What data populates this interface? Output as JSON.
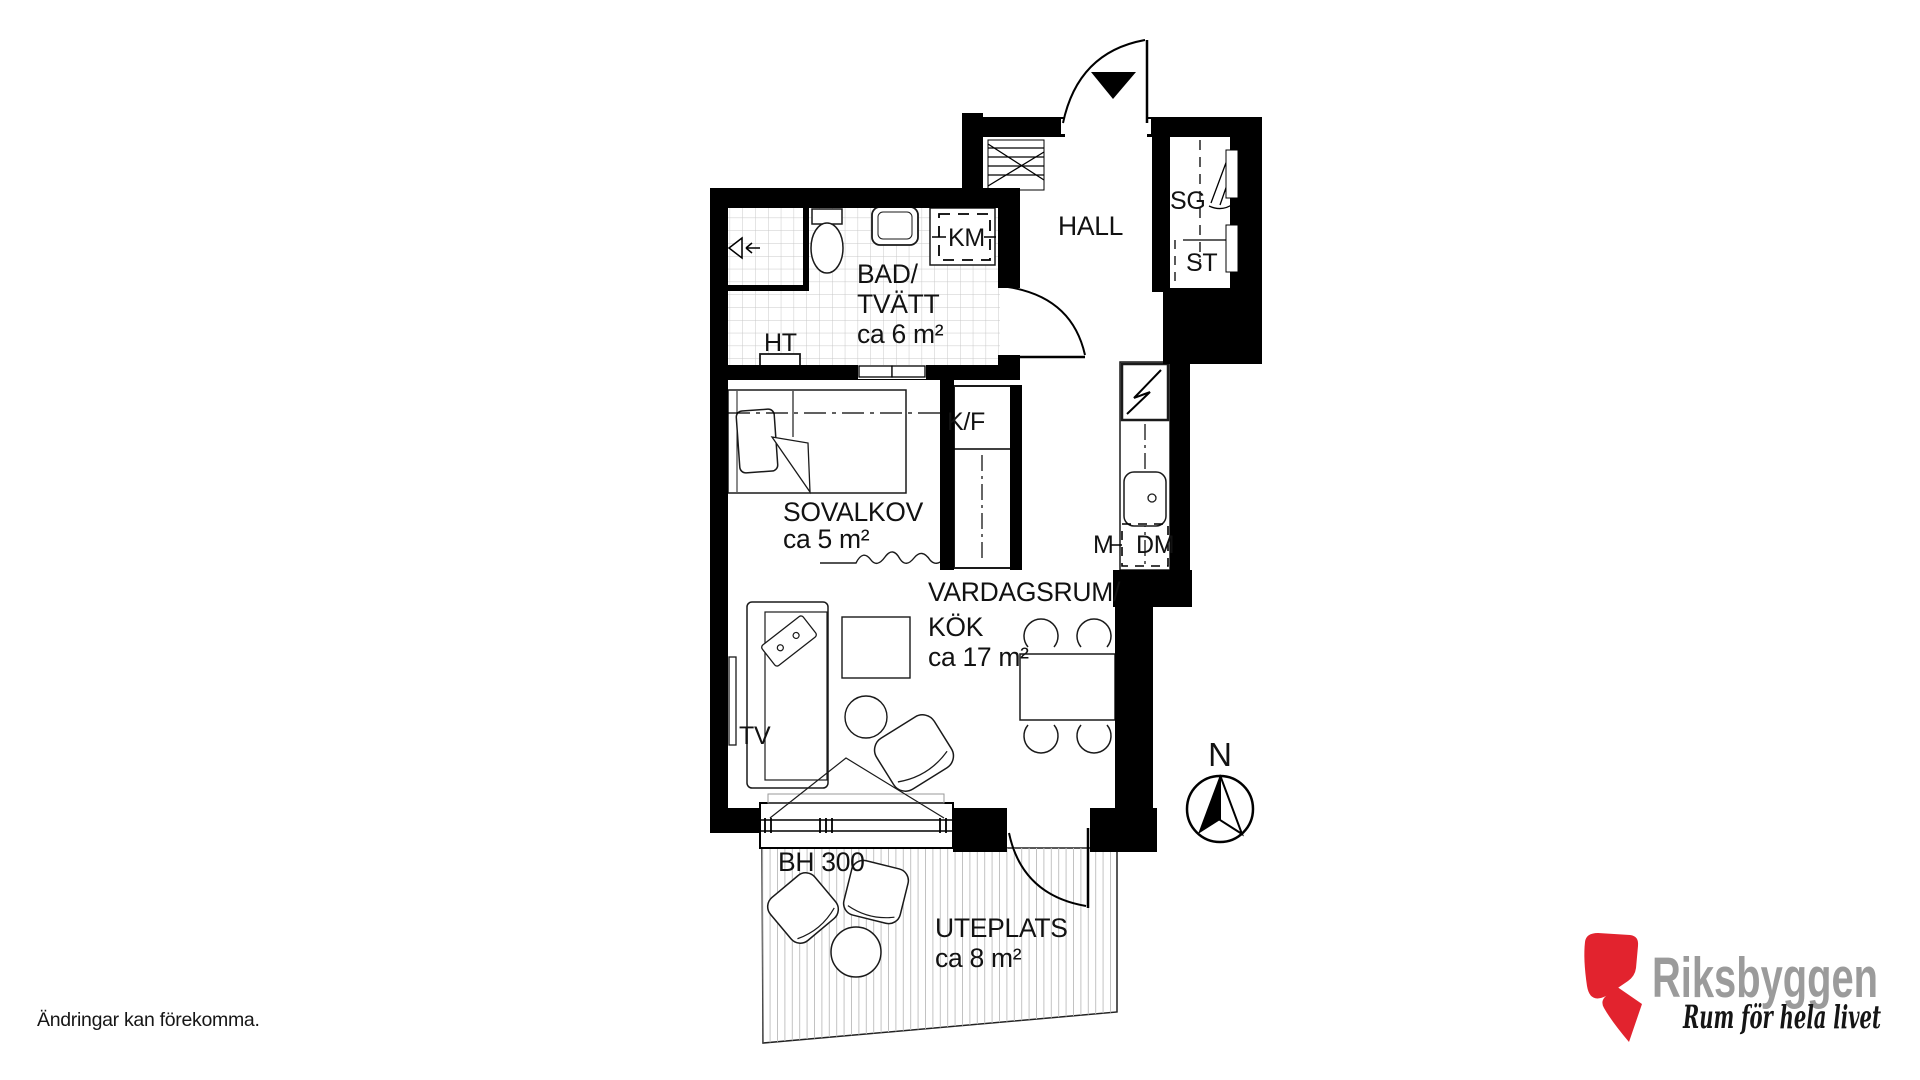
{
  "rooms": {
    "bathroom": {
      "line1": "BAD/",
      "line2": "TVÄTT",
      "area": "ca 6 m²"
    },
    "hall": {
      "name": "HALL"
    },
    "alcove": {
      "name": "SOVALKOV",
      "area": "ca 5 m²"
    },
    "living": {
      "line1": "VARDAGSRUM/",
      "line2": "KÖK",
      "area": "ca 17 m²"
    },
    "patio": {
      "name": "UTEPLATS",
      "area": "ca 8 m²"
    }
  },
  "labels": {
    "km": "KM",
    "ht": "HT",
    "sg": "SG",
    "st": "ST",
    "kf": "K/F",
    "m": "M",
    "dm": "DM",
    "tv": "TV",
    "sill_height": "BH 300",
    "north": "N"
  },
  "footer": {
    "disclaimer": "Ändringar kan förekomma."
  },
  "logo": {
    "brand": "Riksbyggen",
    "tagline": "Rum för hela livet",
    "colors": {
      "mark": "#e2232e",
      "brand_text": "#9b9b9b",
      "tagline_text": "#151515"
    }
  },
  "plan_colors": {
    "wall": "#000000",
    "tile_grid": "#c8c8c8",
    "deck_plank": "#c2c2c2"
  }
}
